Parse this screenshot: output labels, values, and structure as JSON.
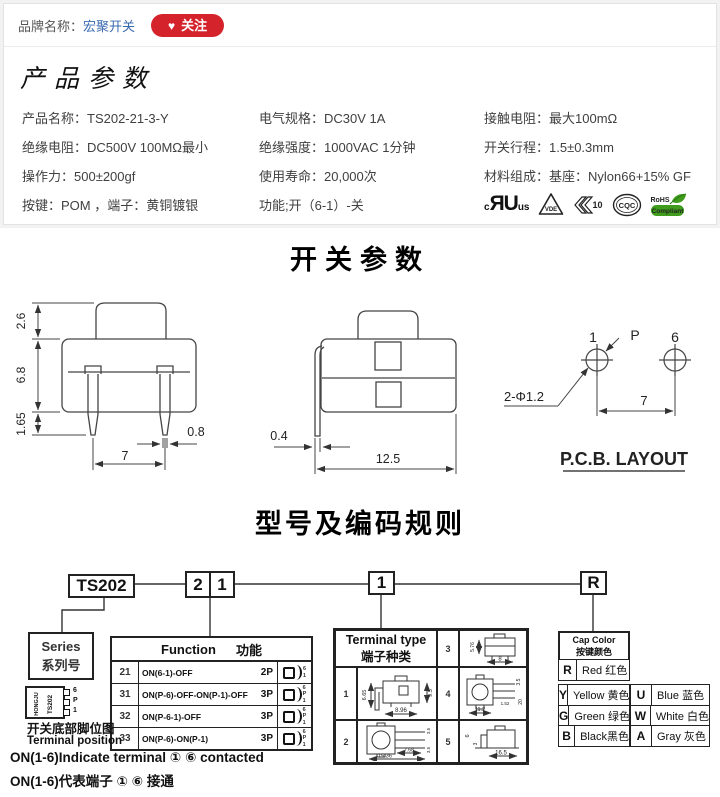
{
  "brand_bar": {
    "label": "品牌名称：",
    "name": "宏聚开关",
    "follow": "关注",
    "heart_icon": "♥"
  },
  "product_params": {
    "title": "产品参数",
    "cells": {
      "r1c1": "产品名称：TS202-21-3-Y",
      "r1c2": "电气规格：DC30V  1A",
      "r1c3": "接触电阻：最大100mΩ",
      "r2c1": "绝缘电阻：DC500V  100MΩ最小",
      "r2c2": "绝缘强度：1000VAC  1分钟",
      "r2c3": "开关行程：1.5±0.3mm",
      "r3c1": "操作力：500±200gf",
      "r3c2": "使用寿命：20,000次",
      "r3c3": "材料组成：基座：Nylon66+15% GF",
      "r4c1": "按键：POM  ，端子：黄铜镀银",
      "r4c2": "功能;开（6-1）-关"
    },
    "certs": {
      "ul_c": "c",
      "ul_mark": "ЯU",
      "ul_us": "us",
      "vde": "VDE",
      "enec": "10",
      "cqc": "CQC",
      "rohs_top": "RoHS",
      "rohs_bottom": "Compliant"
    }
  },
  "switch_section": {
    "title": "开关参数",
    "front": {
      "h_cap": "2.6",
      "h_body": "6.8",
      "h_pin": "1.65",
      "pin_w": "0.8",
      "pitch": "7"
    },
    "side": {
      "pin_w": "0.4",
      "width": "12.5"
    },
    "pcb": {
      "p1": "1",
      "pp": "P",
      "p6": "6",
      "holes": "2-Φ1.2",
      "pitch": "7",
      "caption": "P.C.B. LAYOUT"
    }
  },
  "coding_section": {
    "title": "型号及编码规则",
    "code_series": "TS202",
    "code_func_1": "2",
    "code_func_2": "1",
    "code_terminal": "1",
    "code_color": "R",
    "series_box": {
      "en": "Series",
      "zh": "系列号"
    },
    "function_table": {
      "header_en": "Function",
      "header_zh": "功能",
      "rows": [
        {
          "code": "21",
          "desc": "ON(6-1)-OFF",
          "poles": "2P",
          "pins": [
            "6",
            "1"
          ]
        },
        {
          "code": "31",
          "desc": "ON(P-6)-OFF-ON(P-1)-OFF",
          "poles": "3P",
          "pins": [
            "6",
            "P",
            "1"
          ]
        },
        {
          "code": "32",
          "desc": "ON(P-6-1)-OFF",
          "poles": "3P",
          "pins": [
            "6",
            "P",
            "1"
          ]
        },
        {
          "code": "33",
          "desc": "ON(P-6)-ON(P-1)",
          "poles": "3P",
          "pins": [
            "6",
            "P",
            "1"
          ]
        }
      ]
    },
    "terminal_table": {
      "header_en": "Terminal type",
      "header_zh": "端子种类",
      "cells": [
        {
          "num": "1",
          "dims": [
            "6.65",
            "9.5",
            "8.96"
          ]
        },
        {
          "num": "2",
          "dims": [
            "3.5",
            "3.5",
            "7.68",
            "15.36"
          ]
        },
        {
          "num": "3",
          "dims": [
            "5.76",
            "8"
          ]
        },
        {
          "num": "4",
          "dims": [
            "3.5",
            "1.52",
            "20",
            "11.2"
          ]
        },
        {
          "num": "5",
          "dims": [
            "6",
            "3",
            "16.5"
          ]
        }
      ]
    },
    "cap_color": {
      "header_en": "Cap Color",
      "header_zh": "按键颜色",
      "left": [
        {
          "code": "R",
          "name": "Red 红色"
        },
        {
          "code": "Y",
          "name": "Yellow 黄色"
        },
        {
          "code": "G",
          "name": "Green 绿色"
        },
        {
          "code": "B",
          "name": "Black黑色"
        }
      ],
      "right": [
        {
          "code": "U",
          "name": "Blue 蓝色"
        },
        {
          "code": "W",
          "name": "White 白色"
        },
        {
          "code": "A",
          "name": "Gray 灰色"
        }
      ]
    },
    "chip": {
      "brand": "HONGJU",
      "model": "TS202",
      "pins": [
        "6",
        "P",
        "1"
      ]
    },
    "notes": {
      "zh_title": "开关底部脚位图",
      "en_title": "Terminal position",
      "line1": "ON(1-6)Indicate terminal ① ⑥ contacted",
      "line2": "ON(1-6)代表端子 ① ⑥ 接通"
    }
  }
}
